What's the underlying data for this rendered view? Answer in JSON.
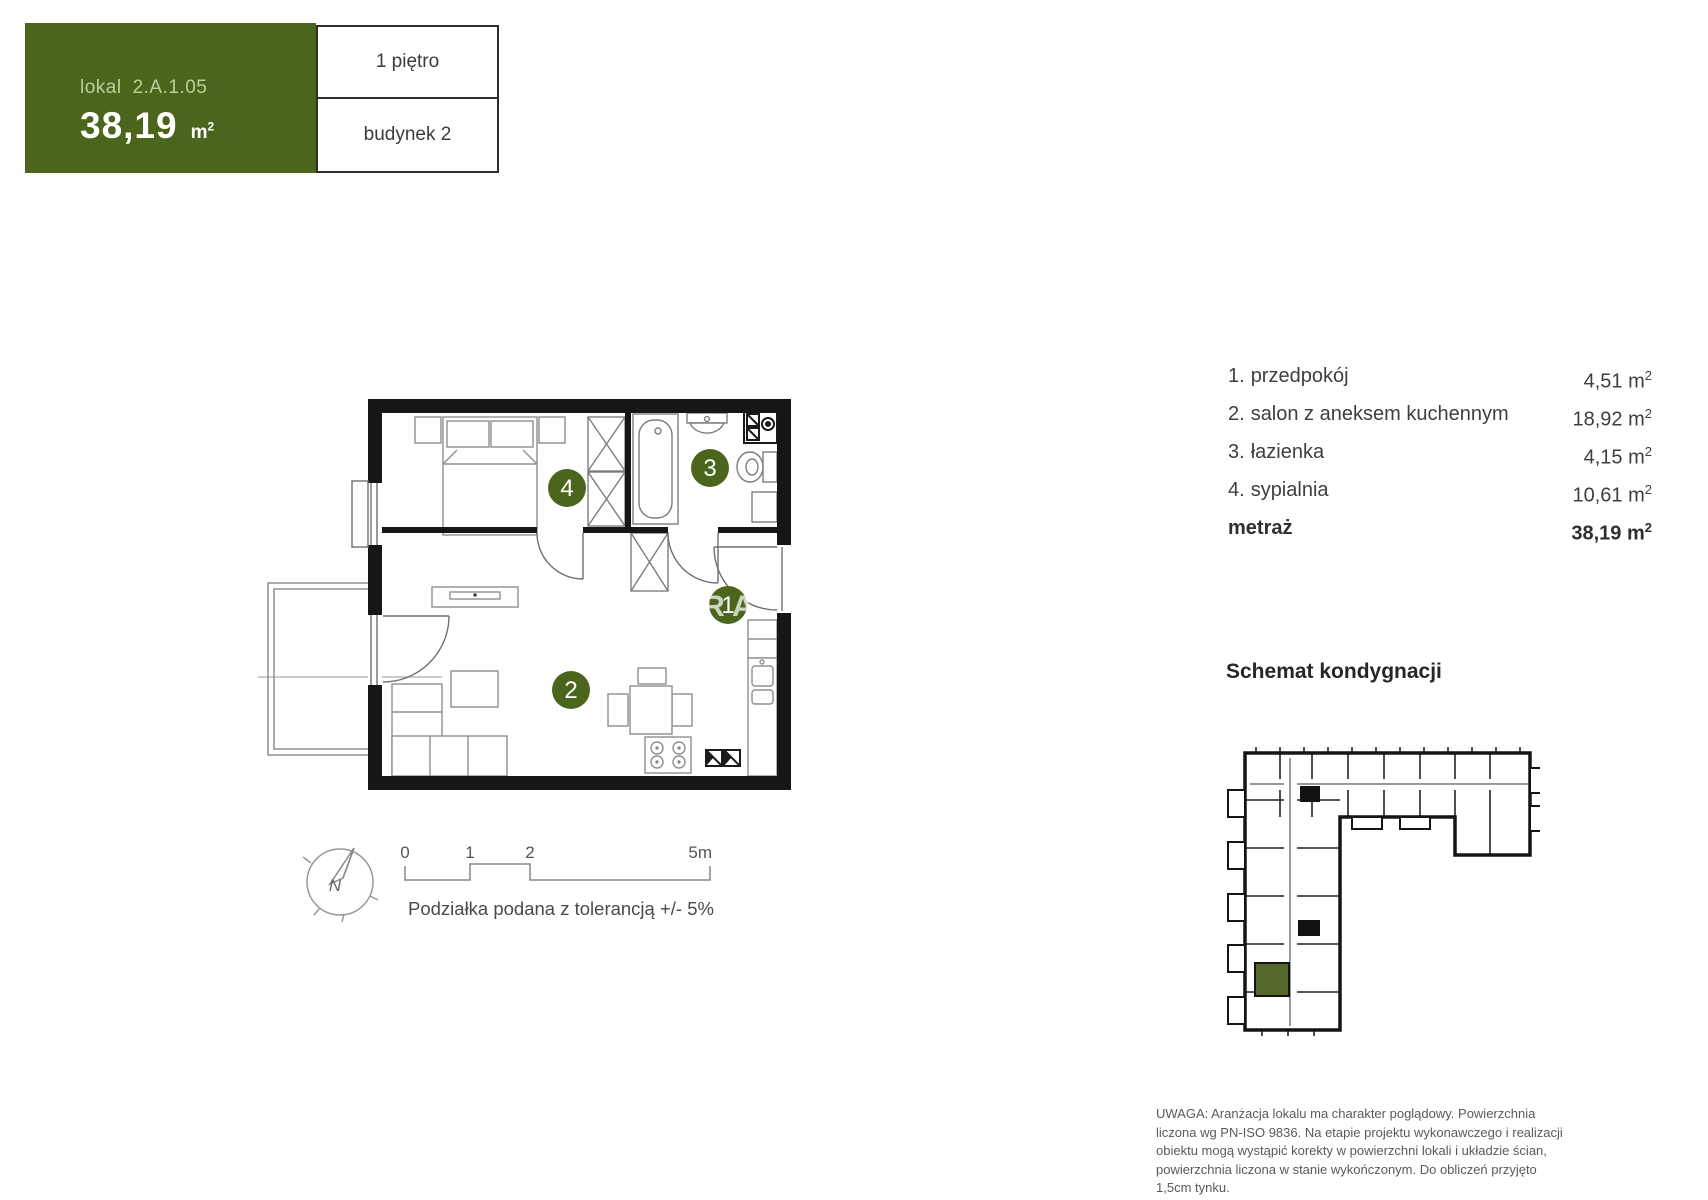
{
  "header": {
    "lokal_label": "lokal",
    "unit_number": "2.A.1.05",
    "area_value": "38,19",
    "floor": "1 piętro",
    "building": "budynek 2"
  },
  "units": {
    "m": "m",
    "sup": "2"
  },
  "rooms": [
    {
      "num": "1.",
      "name": "przedpokój",
      "area": "4,51"
    },
    {
      "num": "2.",
      "name": "salon z aneksem kuchennym",
      "area": "18,92"
    },
    {
      "num": "3.",
      "name": "łazienka",
      "area": "4,15"
    },
    {
      "num": "4.",
      "name": "sypialnia",
      "area": "10,61"
    }
  ],
  "total": {
    "label": "metraż",
    "area": "38,19"
  },
  "floor_schematic": {
    "title": "Schemat kondygnacji"
  },
  "plan": {
    "markers": {
      "hall": "1",
      "living": "2",
      "bath": "3",
      "bedroom": "4"
    },
    "watermark": {
      "r": "R",
      "a": "A"
    }
  },
  "scale": {
    "t0": "0",
    "t1": "1",
    "t2": "2",
    "t3": "5m",
    "caption": "Podziałka podana z tolerancją +/- 5%"
  },
  "compass": {
    "north": "N"
  },
  "disclaimer": "UWAGA: Aranżacja lokalu ma charakter poglądowy. Powierzchnia liczona wg PN-ISO 9836. Na etapie projektu wykonawczego i realizacji obiektu mogą wystąpić korekty w powierzchni lokali i układzie ścian, powierzchnia liczona w stanie wykończonym. Do obliczeń przyjęto 1,5cm tynku.",
  "colors": {
    "brand_green": "#4b661c",
    "light_green": "#bccf9a",
    "schematic_green": "#54682b"
  }
}
